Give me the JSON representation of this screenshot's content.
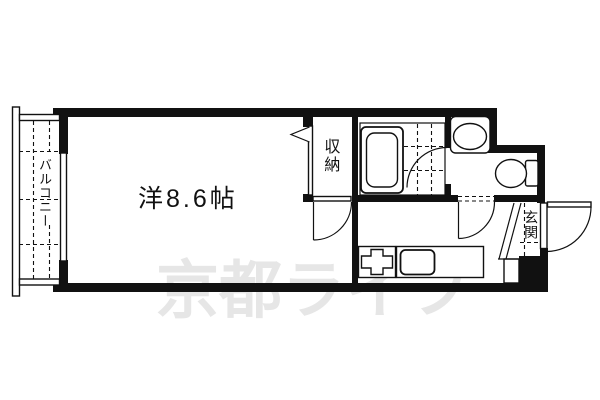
{
  "plan": {
    "rooms": {
      "main_room_label": "洋8.6帖",
      "closet_label": "収納",
      "balcony_label": "バルコニー",
      "entrance_label": "玄関"
    },
    "watermark": {
      "text": "京都ライフ",
      "color": "#e6e6e6"
    },
    "colors": {
      "line": "#111111",
      "background": "#ffffff"
    },
    "fixtures": [
      "bathtub",
      "washbasin",
      "toilet",
      "gas-stove",
      "kitchen-sink",
      "sliding-window",
      "entrance-door",
      "bath-door",
      "closet-folding-door"
    ]
  }
}
